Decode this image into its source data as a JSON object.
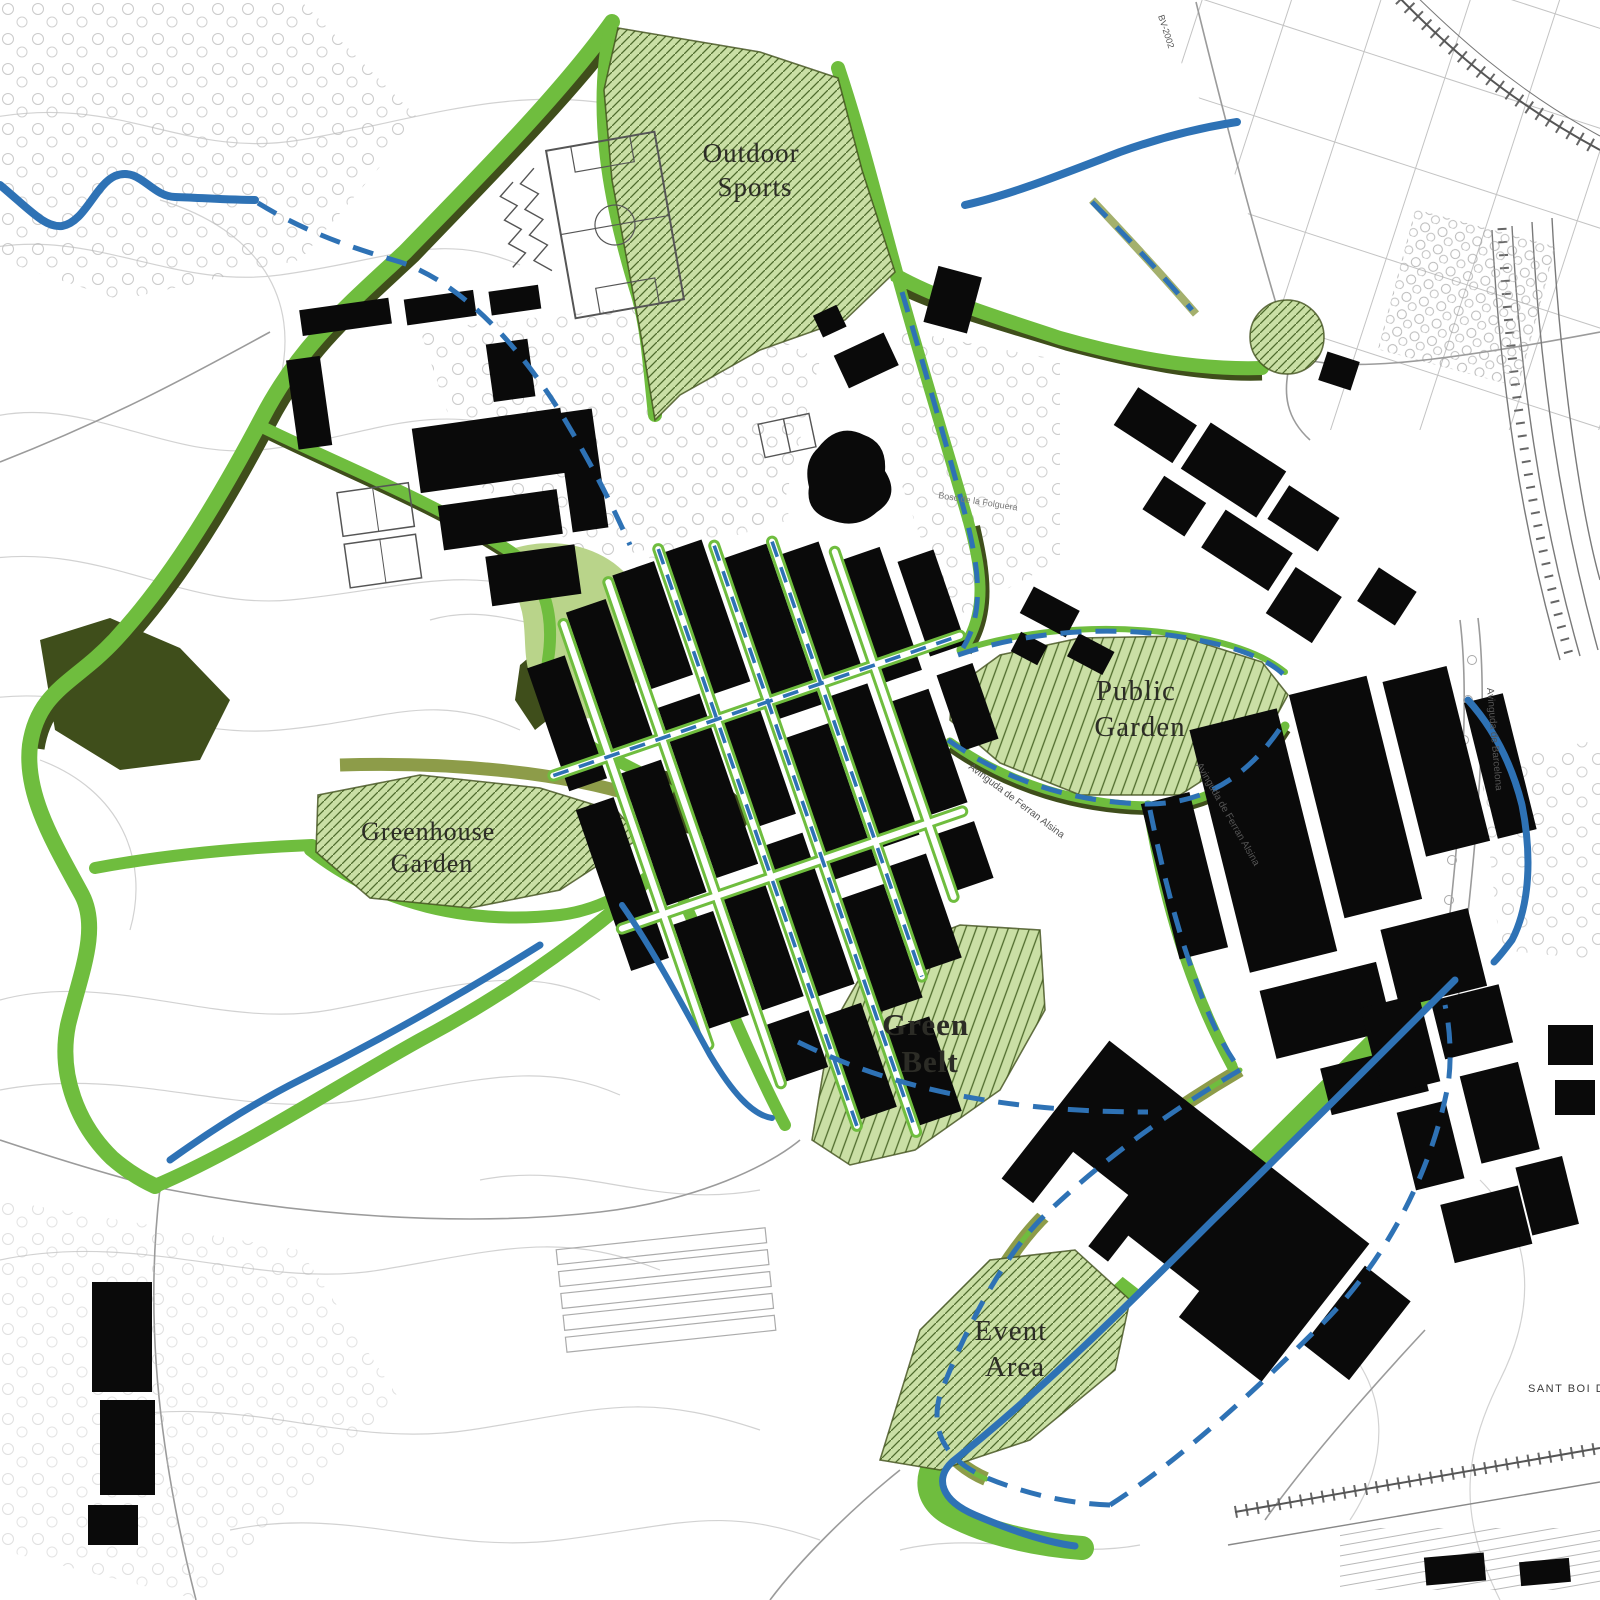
{
  "map": {
    "type": "urban-green-belt-masterplan",
    "areas": [
      {
        "id": "outdoor-sports",
        "line1": "Outdoor",
        "line2": "Sports"
      },
      {
        "id": "public-garden",
        "line1": "Public",
        "line2": "Garden"
      },
      {
        "id": "greenhouse-garden",
        "line1": "Greenhouse",
        "line2": "Garden"
      },
      {
        "id": "green-belt",
        "line1": "Green",
        "line2": "Belt"
      },
      {
        "id": "event-area",
        "line1": "Event",
        "line2": "Area"
      }
    ],
    "street_labels": [
      {
        "id": "av-ferran-alsina-1",
        "text": "Avinguda de Ferran Alsina"
      },
      {
        "id": "av-ferran-alsina-2",
        "text": "Avinguda de Ferran Alsina"
      },
      {
        "id": "av-barcelona",
        "text": "Avinguda de Barcelona"
      },
      {
        "id": "bosc-label",
        "text": "Bosc de la Folguera"
      },
      {
        "id": "bv-road-label",
        "text": "BV-2002"
      }
    ],
    "corner_label": "SANT BOI DE",
    "colors": {
      "belt_green": "#6fbd3e",
      "belt_dark": "#3f4e1b",
      "belt_olive": "#8d9c49",
      "area_fill": "#cadfa5",
      "area_hatch": "#4f6b2c",
      "water_blue": "#2e72b5",
      "building": "#0a0a0a",
      "contour": "#d2d2d2",
      "label": "#2c2c26"
    }
  }
}
